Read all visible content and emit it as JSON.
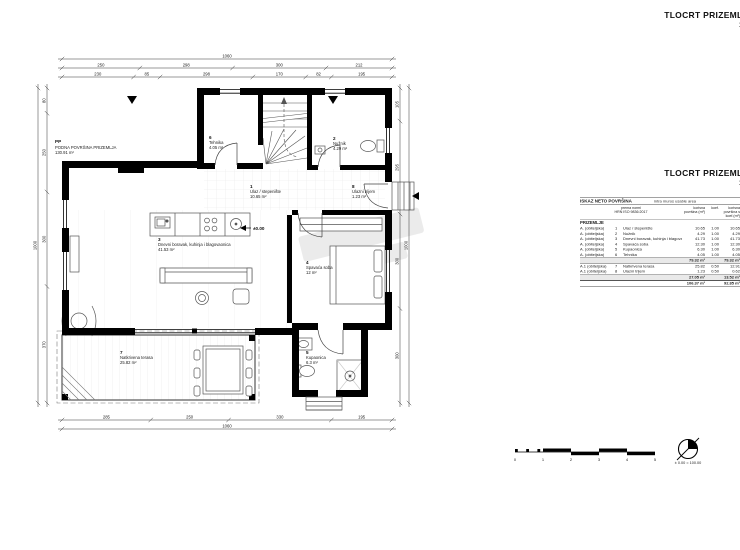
{
  "sheet": {
    "title": "TLOCRT PRIZEMLJA",
    "scale": "1:50",
    "title2": "TLOCRT PRIZEMLJA",
    "scale2": "1:50"
  },
  "plan": {
    "floor_area_label": {
      "code": "PP",
      "name": "PODNA POVRŠINA PRIZEMLJA",
      "area": "130.91 m²"
    },
    "level_marker": "±0.00",
    "rooms": [
      {
        "num": "1",
        "name": "Ulaz / stepenište",
        "area": "10.65 m²"
      },
      {
        "num": "2",
        "name": "Nužnik",
        "area": "4.29 m²"
      },
      {
        "num": "3",
        "name": "Dnevni boravak, kuhinja i blagovaonica",
        "area": "41.53 m²"
      },
      {
        "num": "4",
        "name": "Spavaća soba",
        "area": "12 m²"
      },
      {
        "num": "5",
        "name": "Kupaonica",
        "area": "6.3 m²"
      },
      {
        "num": "6",
        "name": "Tehnika",
        "area": "4.05 m²"
      },
      {
        "num": "7",
        "name": "Natkrivena terasa",
        "area": "25.82 m²"
      },
      {
        "num": "8",
        "name": "Ulazni trijem",
        "area": "1.23 m²"
      }
    ],
    "dims": {
      "top_total": [
        "1060"
      ],
      "top_main": [
        "250",
        "298",
        "300",
        "212"
      ],
      "top_inner": [
        "230",
        "85",
        "298",
        "170",
        "82",
        "195"
      ],
      "bottom_main": [
        "285",
        "250",
        "330",
        "195"
      ],
      "bottom_total": [
        "1060"
      ],
      "left_total": [
        "1000"
      ],
      "left_main": [
        "80",
        "250",
        "300",
        "370"
      ],
      "right_main": [
        "105",
        "295",
        "300",
        "300"
      ],
      "right_total": [
        "1000"
      ]
    }
  },
  "table": {
    "title": "ISKAZ NETO POVRŠINA",
    "subtitle": "intra muros usable area",
    "norm_line1": "prema normi",
    "norm_line2": "HRN ISO 9836:2017",
    "col_area": "korisna površina (m²)",
    "col_koef": "koef.",
    "col_area_koef": "korisna površina s koef.(m²)",
    "section": "PRIZEMLJE",
    "rows": [
      {
        "type": "A. (obiteljska)",
        "num": "1",
        "name": "Ulaz / stepenište",
        "area": "10.65",
        "koef": "1.00",
        "area_koef": "10.65"
      },
      {
        "type": "A. (obiteljska)",
        "num": "2",
        "name": "Nužnik",
        "area": "4.29",
        "koef": "1.00",
        "area_koef": "4.29"
      },
      {
        "type": "A. (obiteljska)",
        "num": "3",
        "name": "Dnevni boravak, kuhinja i blagovaonica",
        "area": "41.73",
        "koef": "1.00",
        "area_koef": "41.73"
      },
      {
        "type": "A. (obiteljska)",
        "num": "4",
        "name": "Spavaća soba",
        "area": "12.30",
        "koef": "1.00",
        "area_koef": "12.30"
      },
      {
        "type": "A. (obiteljska)",
        "num": "5",
        "name": "Kupaonica",
        "area": "6.30",
        "koef": "1.00",
        "area_koef": "6.30"
      },
      {
        "type": "A. (obiteljska)",
        "num": "6",
        "name": "Tehnika",
        "area": "4.05",
        "koef": "1.00",
        "area_koef": "4.05"
      }
    ],
    "subtotal1": {
      "area": "79.32 m²",
      "area_koef": "79.32 m²"
    },
    "rows2": [
      {
        "type": "A.1 (obiteljska)",
        "num": "7",
        "name": "Natkrivena terasa",
        "area": "25.82",
        "koef": "0.50",
        "area_koef": "12.91"
      },
      {
        "type": "A.1 (obiteljska)",
        "num": "8",
        "name": "Ulazni trijem",
        "area": "1.23",
        "koef": "0.50",
        "area_koef": "0.62"
      }
    ],
    "subtotal2": {
      "area": "27.05 m²",
      "area_koef": "13.52 m²"
    },
    "total": {
      "area": "106.37 m²",
      "area_koef": "92.85 m²"
    }
  },
  "scalebar": {
    "labels": [
      "0",
      "1",
      "2",
      "3",
      "4",
      "5"
    ]
  },
  "benchmark": {
    "label": "± 0.00 = 100.00"
  }
}
